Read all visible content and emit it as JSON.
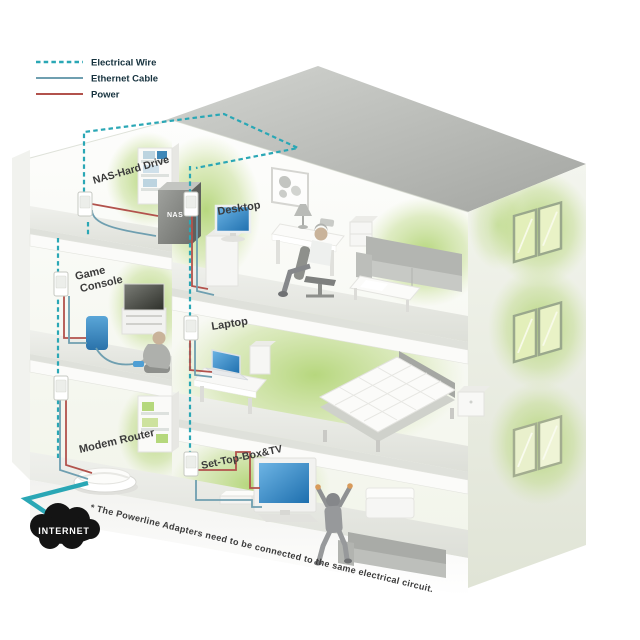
{
  "legend": {
    "items": [
      {
        "label": "Electrical Wire",
        "type": "electrical"
      },
      {
        "label": "Ethernet Cable",
        "type": "ethernet"
      },
      {
        "label": "Power",
        "type": "power"
      }
    ]
  },
  "rooms": {
    "nas_label": "NAS-Hard Drive",
    "desktop_label": "Desktop",
    "game_label_line1": "Game",
    "game_label_line2": "Console",
    "laptop_label": "Laptop",
    "modem_label": "Modem Router",
    "settop_label": "Set-Top-Box&TV"
  },
  "devices": {
    "nas_badge": "NAS"
  },
  "internet": {
    "label": "INTERNET"
  },
  "footnote": "* The Powerline Adapters need to be connected to the same electrical circuit.",
  "colors": {
    "electrical_wire": "#2AA7B5",
    "ethernet_cable": "#6F9FB0",
    "power": "#B2524C",
    "accent_green": "#B5D87C",
    "screen_blue": "#2E7FC2",
    "cloud_black": "#141414",
    "label_text": "#3B3B3B",
    "legend_text": "#16323E"
  }
}
